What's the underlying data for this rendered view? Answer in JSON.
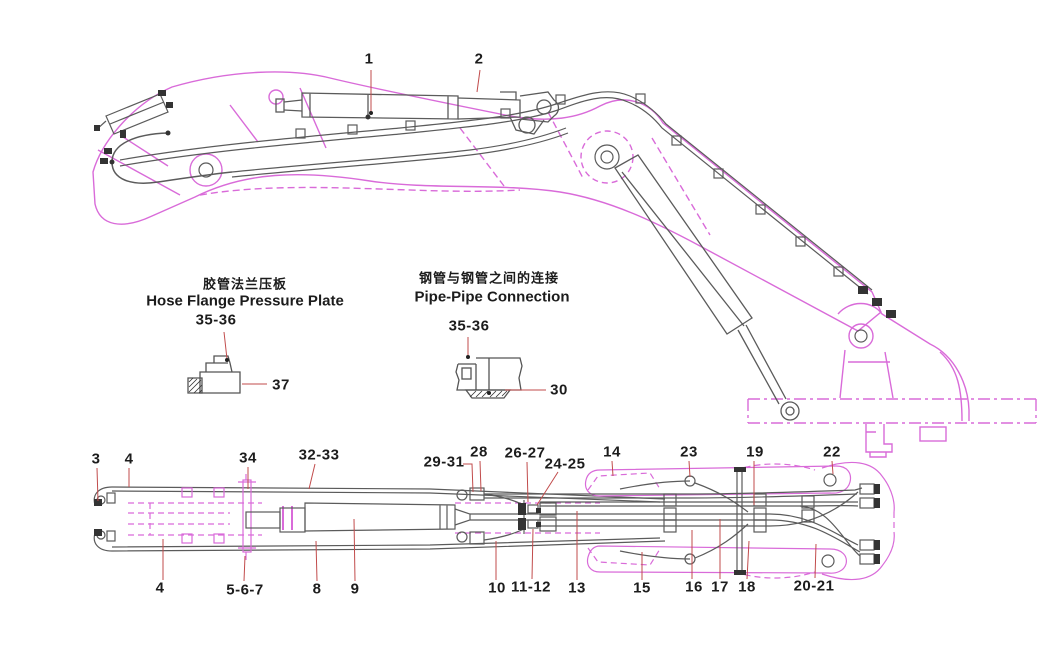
{
  "colors": {
    "structure_magenta": "#d96bd9",
    "pipe_gray": "#5b5b5b",
    "leader_red": "#c14b4b",
    "text": "#1c1c1c",
    "background": "#ffffff"
  },
  "top_view": {
    "callouts": [
      "1",
      "2"
    ]
  },
  "details": [
    {
      "title_zh": "胶管法兰压板",
      "title_en": "Hose Flange Pressure Plate",
      "callout_pin": "35-36",
      "callout_part": "37"
    },
    {
      "title_zh": "钢管与钢管之间的连接",
      "title_en": "Pipe-Pipe Connection",
      "callout_pin": "35-36",
      "callout_part": "30"
    }
  ],
  "bottom_view": {
    "callouts_top": [
      "3",
      "4",
      "34",
      "32-33",
      "29-31",
      "28",
      "26-27",
      "24-25",
      "14",
      "23",
      "19",
      "22"
    ],
    "callouts_bottom": [
      "4",
      "5-6-7",
      "8",
      "9",
      "10",
      "11-12",
      "13",
      "15",
      "16",
      "17",
      "18",
      "20-21"
    ]
  }
}
